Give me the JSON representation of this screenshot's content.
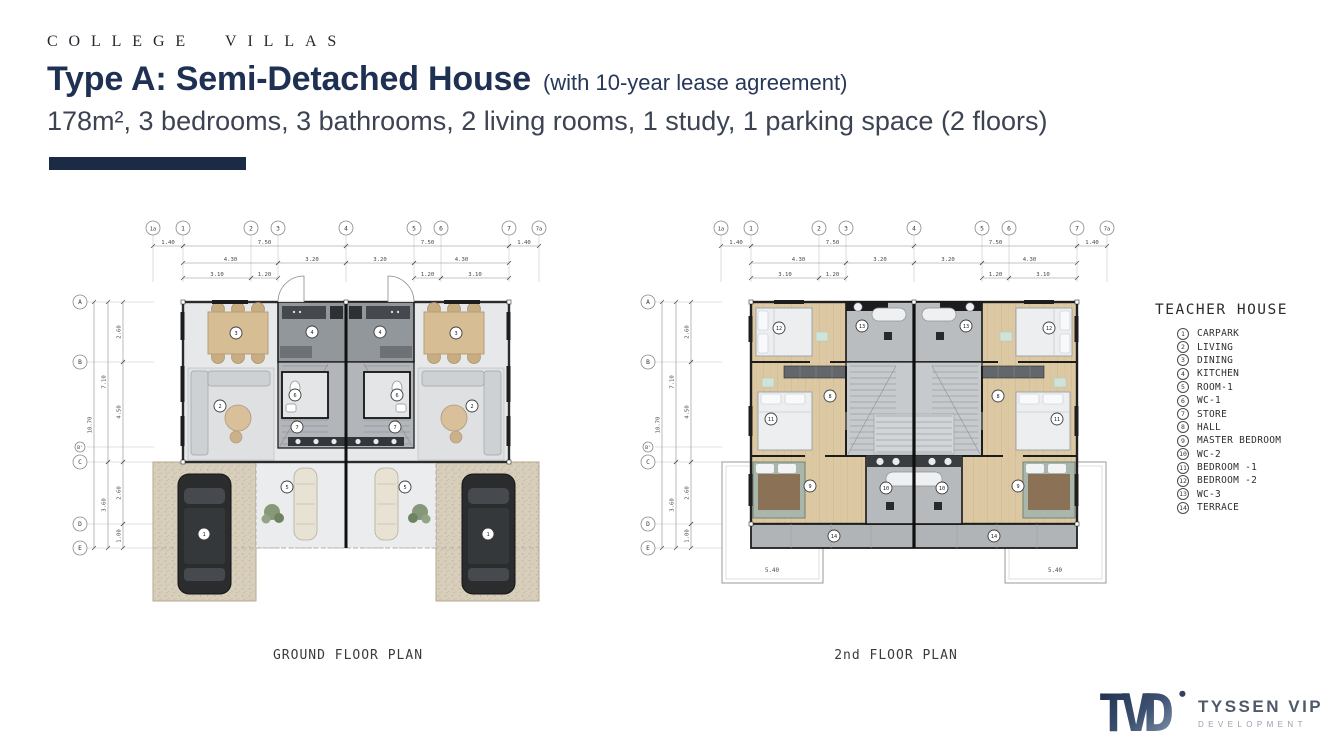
{
  "slide": {
    "brand": "COLLEGE VILLAS",
    "title": "Type A: Semi-Detached House",
    "title_suffix": "(with 10-year lease agreement)",
    "subtitle": "178m², 3 bedrooms, 3 bathrooms, 2 living rooms, 1 study, 1 parking space (2 floors)"
  },
  "plans": {
    "grid_cols": [
      "1a",
      "1",
      "2",
      "3",
      "4",
      "5",
      "6",
      "7",
      "7a"
    ],
    "grid_rows": [
      "A",
      "B",
      "B'",
      "C",
      "D",
      "E"
    ],
    "dims_row1": [
      "1.40",
      "7.50",
      "7.50",
      "1.40"
    ],
    "dims_row2": [
      "4.30",
      "3.20",
      "3.20",
      "4.30"
    ],
    "dims_row3": [
      "3.10",
      "1.20",
      "1.20",
      "3.10"
    ],
    "dims_left_inner": [
      "2.60",
      "4.50",
      "2.60",
      "1.00"
    ],
    "dims_left_outer": [
      "7.10",
      "3.60"
    ],
    "dims_left_total": [
      "10.70"
    ],
    "ground": {
      "caption": "GROUND FLOOR PLAN",
      "room_markers": [
        "3",
        "4",
        "4",
        "3",
        "2",
        "6",
        "6",
        "2",
        "7",
        "7",
        "5",
        "5",
        "1",
        "1"
      ]
    },
    "second": {
      "caption": "2nd FLOOR PLAN",
      "terrace_dim": "5.40",
      "room_markers": [
        "12",
        "13",
        "13",
        "12",
        "8",
        "8",
        "11",
        "11",
        "9",
        "10",
        "10",
        "9",
        "14",
        "14"
      ]
    }
  },
  "legend": {
    "title": "TEACHER HOUSE",
    "items": [
      {
        "num": "1",
        "label": "CARPARK"
      },
      {
        "num": "2",
        "label": "LIVING"
      },
      {
        "num": "3",
        "label": "DINING"
      },
      {
        "num": "4",
        "label": "KITCHEN"
      },
      {
        "num": "5",
        "label": "ROOM-1"
      },
      {
        "num": "6",
        "label": "WC-1"
      },
      {
        "num": "7",
        "label": "STORE"
      },
      {
        "num": "8",
        "label": "HALL"
      },
      {
        "num": "9",
        "label": "MASTER BEDROOM"
      },
      {
        "num": "10",
        "label": "WC-2"
      },
      {
        "num": "11",
        "label": "BEDROOM -1"
      },
      {
        "num": "12",
        "label": "BEDROOM -2"
      },
      {
        "num": "13",
        "label": "WC-3"
      },
      {
        "num": "14",
        "label": "TERRACE"
      }
    ]
  },
  "logo": {
    "mark": "TVD",
    "name": "TYSSEN VIP",
    "subname": "DEVELOPMENT"
  },
  "palette": {
    "navy_title": "#1e3153",
    "bar_navy": "#1b2b45",
    "subtitle_gray": "#3c4352",
    "wood_floor": "#dcc8a2",
    "gravel": "#d8cebc",
    "core_gray": "#92979c",
    "terrace_gray": "#b0b4b7",
    "wall_dark": "#1f1f1f"
  }
}
